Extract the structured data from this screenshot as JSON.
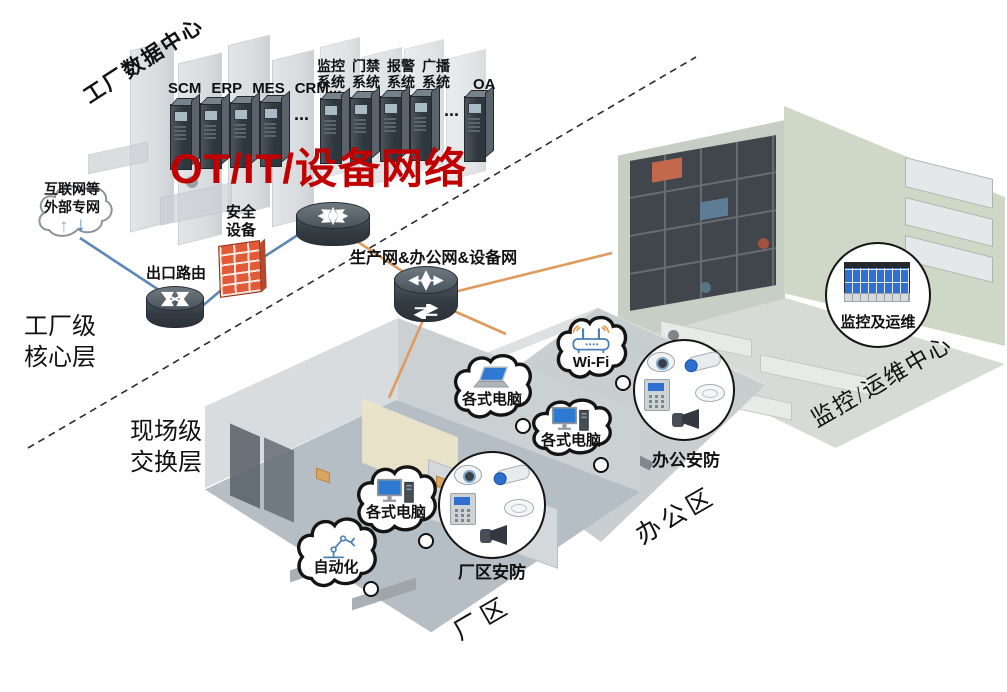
{
  "palette": {
    "title_red": "#c00000",
    "orange_line": "#df9a5e",
    "blue_line": "#5c88b6",
    "firewall_red": "#e25a38"
  },
  "title": "OT/IT/设备网络",
  "data_center": {
    "label": "工厂数据中心",
    "app_servers": [
      "SCM",
      "ERP",
      "MES",
      "CRM..."
    ],
    "sys_servers": [
      "监控\n系统",
      "门禁\n系统",
      "报警\n系统",
      "广播\n系统"
    ],
    "oa_label": "OA",
    "ellipsis": "..."
  },
  "core_layer": {
    "external_label": "互联网等\n外部专网",
    "up_arrow": "↑",
    "down_arrow": "↓",
    "edge_router_label": "出口路由",
    "security_device_label": "安全\n设备",
    "network_label": "生产网&办公网&设备网",
    "layer_label": "工厂级\n核心层"
  },
  "field_layer": {
    "layer_label": "现场级\n交换层"
  },
  "bubbles": {
    "office_laptop": "各式电脑",
    "office_pc": "各式电脑",
    "wifi": "Wi-Fi",
    "factory_pc": "各式电脑",
    "automation": "自动化"
  },
  "security_groups": {
    "factory": "厂区安防",
    "office": "办公安防",
    "monitoring": "监控及运维"
  },
  "rooms": {
    "factory": "厂区",
    "office": "办公区",
    "noc": "监控/运维中心"
  }
}
